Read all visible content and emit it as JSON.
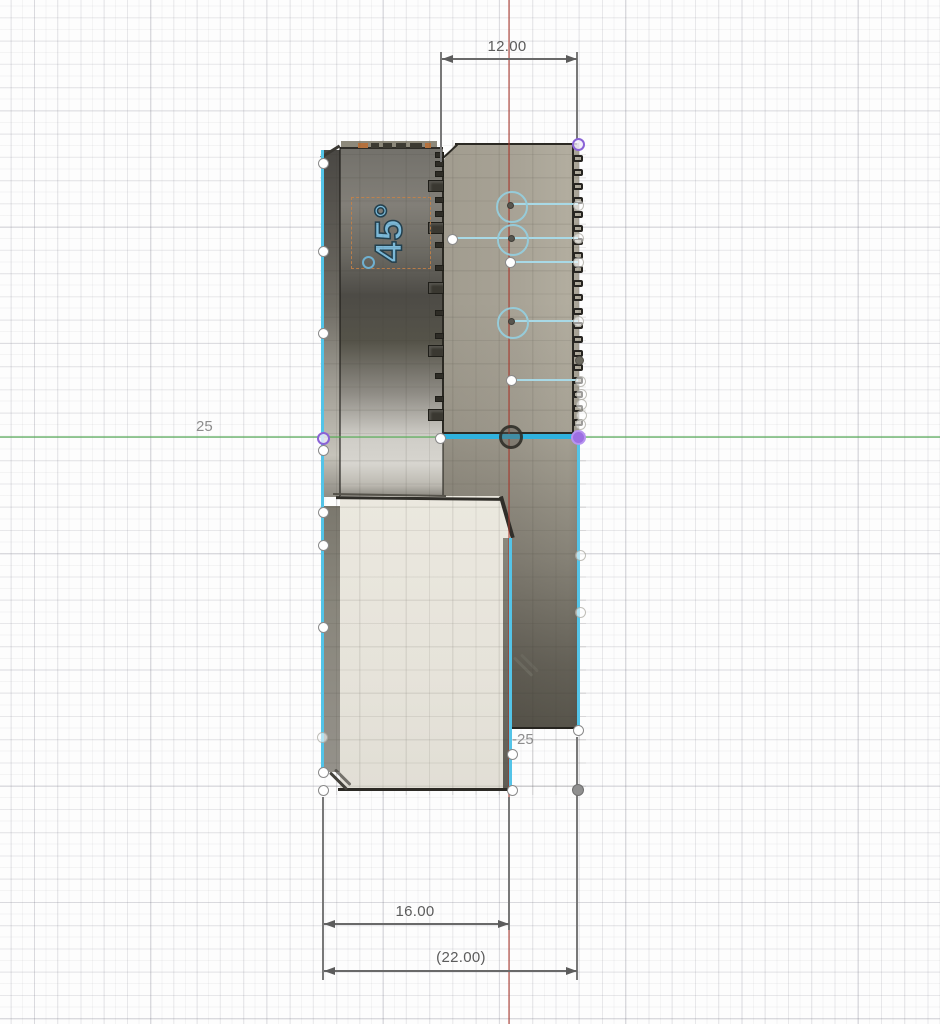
{
  "view": {
    "type": "cad-sketch-view",
    "grid_labels": {
      "x_axis": "25",
      "y_axis": "-25"
    },
    "colors": {
      "highlight_cyan": "#53c4e8",
      "selected_cyan": "#2fb2de",
      "axis_red": "rgba(170,50,38,0.5)",
      "axis_green": "rgba(80,175,80,0.55)",
      "dimension_text": "#5c5c5c",
      "grid_label": "#8d8d8d",
      "construction_blue": "#a8d9e6",
      "point_purple": "#9d6fe2",
      "engraving_blue": "#7cb9d8",
      "textbox_orange": "#c9854e"
    }
  },
  "dimensions": {
    "top_width": {
      "label": "12.00"
    },
    "inner_width": {
      "label": "16.00"
    },
    "outer_width": {
      "label": "(22.00)"
    }
  },
  "engraving": {
    "text": "45°"
  },
  "sketch": {
    "blue_lines": [
      {
        "x1": 510,
        "x2": 578,
        "y": 204
      },
      {
        "x1": 452,
        "x2": 578,
        "y": 238
      },
      {
        "x1": 510,
        "x2": 578,
        "y": 262
      },
      {
        "x1": 511,
        "x2": 578,
        "y": 321
      },
      {
        "x1": 511,
        "x2": 578,
        "y": 380
      }
    ],
    "blue_circles": [
      {
        "x": 510,
        "y": 205,
        "r": 14
      },
      {
        "x": 511,
        "y": 238,
        "r": 14
      },
      {
        "x": 511,
        "y": 321,
        "r": 14
      }
    ],
    "points": [
      {
        "x": 323,
        "y": 163,
        "t": "white"
      },
      {
        "x": 323,
        "y": 251,
        "t": "white"
      },
      {
        "x": 323,
        "y": 333,
        "t": "white"
      },
      {
        "x": 323,
        "y": 438,
        "t": "purple-ring"
      },
      {
        "x": 323,
        "y": 450,
        "t": "white"
      },
      {
        "x": 323,
        "y": 512,
        "t": "white"
      },
      {
        "x": 323,
        "y": 545,
        "t": "white"
      },
      {
        "x": 323,
        "y": 627,
        "t": "white"
      },
      {
        "x": 322,
        "y": 737,
        "t": "faint"
      },
      {
        "x": 323,
        "y": 772,
        "t": "white"
      },
      {
        "x": 323,
        "y": 790,
        "t": "white"
      },
      {
        "x": 440,
        "y": 438,
        "t": "white"
      },
      {
        "x": 452,
        "y": 239,
        "t": "white"
      },
      {
        "x": 510,
        "y": 205,
        "t": "center"
      },
      {
        "x": 511,
        "y": 238,
        "t": "center"
      },
      {
        "x": 511,
        "y": 321,
        "t": "center"
      },
      {
        "x": 510,
        "y": 262,
        "t": "white"
      },
      {
        "x": 511,
        "y": 380,
        "t": "white"
      },
      {
        "x": 511,
        "y": 437,
        "t": "origin"
      },
      {
        "x": 512,
        "y": 754,
        "t": "white"
      },
      {
        "x": 512,
        "y": 790,
        "t": "white"
      },
      {
        "x": 578,
        "y": 144,
        "t": "purple-ring"
      },
      {
        "x": 578,
        "y": 205,
        "t": "faint"
      },
      {
        "x": 578,
        "y": 238,
        "t": "faint"
      },
      {
        "x": 578,
        "y": 262,
        "t": "faint"
      },
      {
        "x": 578,
        "y": 321,
        "t": "faint"
      },
      {
        "x": 580,
        "y": 381,
        "t": "faint"
      },
      {
        "x": 581,
        "y": 394,
        "t": "faint"
      },
      {
        "x": 581,
        "y": 404,
        "t": "faint"
      },
      {
        "x": 581,
        "y": 415,
        "t": "faint"
      },
      {
        "x": 580,
        "y": 424,
        "t": "faint"
      },
      {
        "x": 579,
        "y": 360,
        "t": "gray-dot"
      },
      {
        "x": 578,
        "y": 437,
        "t": "purple-fill"
      },
      {
        "x": 580,
        "y": 555,
        "t": "faint"
      },
      {
        "x": 580,
        "y": 612,
        "t": "faint"
      },
      {
        "x": 578,
        "y": 730,
        "t": "white"
      },
      {
        "x": 578,
        "y": 790,
        "t": "gray-fill"
      }
    ],
    "right_teeth": {
      "x": 573,
      "y_start": 155,
      "step": 13.9,
      "count": 21
    },
    "mid_teeth": [
      {
        "y": 155,
        "s": "S"
      },
      {
        "y": 164,
        "s": "S"
      },
      {
        "y": 174,
        "s": "S"
      },
      {
        "y": 186,
        "s": "L"
      },
      {
        "y": 200,
        "s": "S"
      },
      {
        "y": 214,
        "s": "S"
      },
      {
        "y": 228,
        "s": "L"
      },
      {
        "y": 245,
        "s": "S"
      },
      {
        "y": 268,
        "s": "S"
      },
      {
        "y": 288,
        "s": "L"
      },
      {
        "y": 313,
        "s": "S"
      },
      {
        "y": 336,
        "s": "S"
      },
      {
        "y": 351,
        "s": "L"
      },
      {
        "y": 376,
        "s": "S"
      },
      {
        "y": 399,
        "s": "S"
      },
      {
        "y": 415,
        "s": "L"
      }
    ],
    "top_dashes": [
      {
        "x": 358,
        "w": 10,
        "c": "#b5713d"
      },
      {
        "x": 371,
        "w": 8,
        "c": "#3c3a32"
      },
      {
        "x": 383,
        "w": 9,
        "c": "#3c3a32"
      },
      {
        "x": 396,
        "w": 10,
        "c": "#3c3a32"
      },
      {
        "x": 410,
        "w": 12,
        "c": "#3c3a32"
      },
      {
        "x": 425,
        "w": 6,
        "c": "#b5713d"
      }
    ]
  }
}
